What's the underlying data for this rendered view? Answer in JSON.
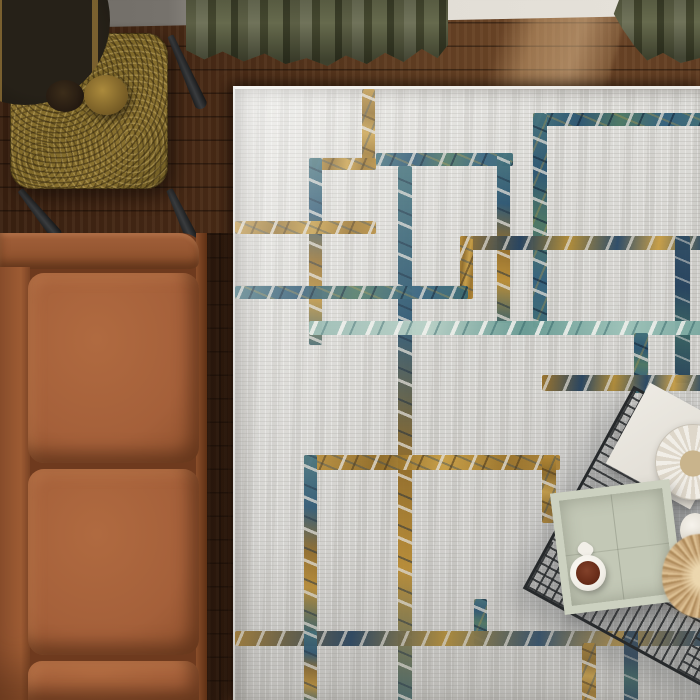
{
  "scene": {
    "description": "Top-down view of a living room corner: distressed geometric area rug, caramel leather sofa, brass side table with cream lamp, olive velvet curtains, black wire-frame coffee table with sage tray, coffee mug, striped plate and pampas stem",
    "view": "overhead"
  },
  "palette": {
    "floor-dark": "#371f10",
    "floor-mid": "#5b3a20",
    "floor-light": "#6b4527",
    "wall-grey": "#6f6b65",
    "wall-light": "#e2ded6",
    "curtain-olive": "#5c5f45",
    "curtain-shadow": "#3a3d28",
    "rug-base": "#d8d7d3",
    "rug-dark": "#c8c7c3",
    "line-gold": "#b98c34",
    "line-teal": "#3f6e78",
    "line-navy": "#23405c",
    "line-seafoam": "#8fb4ab",
    "sofa-leather": "#a5603a",
    "sofa-light": "#b06a40",
    "sofa-shadow": "#7e4424",
    "brass": "#8a7230",
    "lamp-shade": "#e8e4d9",
    "wire-black": "#26292b",
    "tray-sage": "#c3c8b6",
    "coffee": "#6b2e1a",
    "pampas": "#c9a87b",
    "mug-white": "#f2efe8"
  },
  "objects": [
    {
      "name": "wood-floor",
      "label": "dark walnut plank floor"
    },
    {
      "name": "wall",
      "label": "wall with baseboard, grey to white"
    },
    {
      "name": "curtain-left",
      "label": "olive velvet curtain puddling on floor"
    },
    {
      "name": "curtain-right",
      "label": "olive velvet curtain edge"
    },
    {
      "name": "area-rug",
      "label": "grey distressed rug with interlocking gold and teal rectangles"
    },
    {
      "name": "sofa",
      "label": "caramel leather sofa, top-down"
    },
    {
      "name": "side-table",
      "label": "brass guilloche side table with black legs"
    },
    {
      "name": "lamp",
      "label": "cream drum shade lamp with brass base"
    },
    {
      "name": "coffee-table",
      "label": "black wire-frame coffee table"
    },
    {
      "name": "tray",
      "label": "sage green square tray"
    },
    {
      "name": "mug",
      "label": "white mug with coffee"
    },
    {
      "name": "plate",
      "label": "striped ceramic dish"
    },
    {
      "name": "book",
      "label": "white book / paper"
    },
    {
      "name": "pampas",
      "label": "dried pampas stem"
    },
    {
      "name": "vase",
      "label": "small white vessel"
    },
    {
      "name": "sun-patch",
      "label": "sunlight patch on floor"
    }
  ],
  "rug": {
    "origin": {
      "left": 233,
      "top": 86,
      "width": 467,
      "height": 614
    },
    "lines": [
      {
        "x": 127,
        "y": 0,
        "w": 13,
        "h": 80,
        "c": "goldv"
      },
      {
        "x": 141,
        "y": 64,
        "w": 137,
        "h": 13,
        "c": "teal"
      },
      {
        "x": 298,
        "y": 24,
        "w": 169,
        "h": 13,
        "c": "teal"
      },
      {
        "x": 298,
        "y": 24,
        "w": 14,
        "h": 215,
        "c": "tealv"
      },
      {
        "x": 262,
        "y": 64,
        "w": 13,
        "h": 170,
        "c": "mixv"
      },
      {
        "x": 77,
        "y": 69,
        "w": 64,
        "h": 12,
        "c": "gold"
      },
      {
        "x": 74,
        "y": 69,
        "w": 13,
        "h": 187,
        "c": "mixv"
      },
      {
        "x": 0,
        "y": 132,
        "w": 141,
        "h": 13,
        "c": "gold"
      },
      {
        "x": 163,
        "y": 77,
        "w": 14,
        "h": 537,
        "c": "mixv"
      },
      {
        "x": 225,
        "y": 147,
        "w": 242,
        "h": 14,
        "c": "mix2"
      },
      {
        "x": 225,
        "y": 147,
        "w": 13,
        "h": 63,
        "c": "gold"
      },
      {
        "x": 440,
        "y": 147,
        "w": 15,
        "h": 147,
        "c": "tealdark"
      },
      {
        "x": 0,
        "y": 197,
        "w": 233,
        "h": 13,
        "c": "teal"
      },
      {
        "x": 74,
        "y": 232,
        "w": 393,
        "h": 14,
        "c": "seafoam"
      },
      {
        "x": 399,
        "y": 244,
        "w": 14,
        "h": 60,
        "c": "tealv"
      },
      {
        "x": 307,
        "y": 286,
        "w": 160,
        "h": 16,
        "c": "mix2"
      },
      {
        "x": 69,
        "y": 366,
        "w": 256,
        "h": 15,
        "c": "gold"
      },
      {
        "x": 69,
        "y": 366,
        "w": 13,
        "h": 176,
        "c": "mixv"
      },
      {
        "x": 307,
        "y": 366,
        "w": 14,
        "h": 68,
        "c": "goldv"
      },
      {
        "x": 239,
        "y": 510,
        "w": 13,
        "h": 46,
        "c": "tealv"
      },
      {
        "x": 0,
        "y": 542,
        "w": 467,
        "h": 15,
        "c": "mix2"
      },
      {
        "x": 389,
        "y": 542,
        "w": 14,
        "h": 72,
        "c": "tealdark"
      },
      {
        "x": 347,
        "y": 554,
        "w": 14,
        "h": 60,
        "c": "goldv"
      },
      {
        "x": 69,
        "y": 542,
        "w": 13,
        "h": 72,
        "c": "mixv"
      }
    ]
  }
}
